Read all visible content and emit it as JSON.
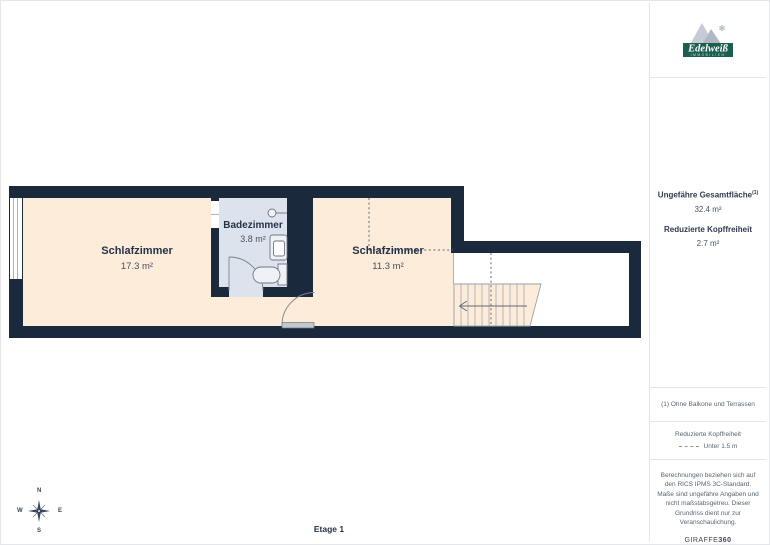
{
  "colors": {
    "wall": "#1b293c",
    "room": "#fdecd9",
    "bath": "#dde3ed",
    "logo_green": "#1c5f50",
    "border": "#e4e6ea"
  },
  "floorplan": {
    "rooms": [
      {
        "name": "Schlafzimmer",
        "area": "17.3 m²"
      },
      {
        "name": "Badezimmer",
        "area": "3.8 m²"
      },
      {
        "name": "Schlafzimmer",
        "area": "11.3 m²"
      }
    ],
    "floor_label": "Etage 1",
    "compass": {
      "n": "N",
      "e": "E",
      "s": "S",
      "w": "W"
    }
  },
  "sidebar": {
    "logo": {
      "brand": "Edelweiß",
      "sub": "IMMOBILIEN"
    },
    "total_area_label": "Ungefähre Gesamtfläche",
    "total_area_sup": "(1)",
    "total_area_value": "32.4 m²",
    "reduced_label": "Reduzierte Kopffreiheit",
    "reduced_value": "2.7 m²",
    "footnote": "(1) Ohne Balkone und Terrassen",
    "legend_title": "Reduzierte Kopffreiheit",
    "legend_item": "Unter 1.5 m",
    "disclaimer": "Berechnungen beziehen sich auf den RICS IPMS 3C-Standard. Maße sind ungefähre Angaben und nicht maßstabsgetreu. Dieser Grundriss dient nur zur Veranschaulichung.",
    "brand_footer_normal": "GIRAFFE",
    "brand_footer_bold": "360"
  }
}
